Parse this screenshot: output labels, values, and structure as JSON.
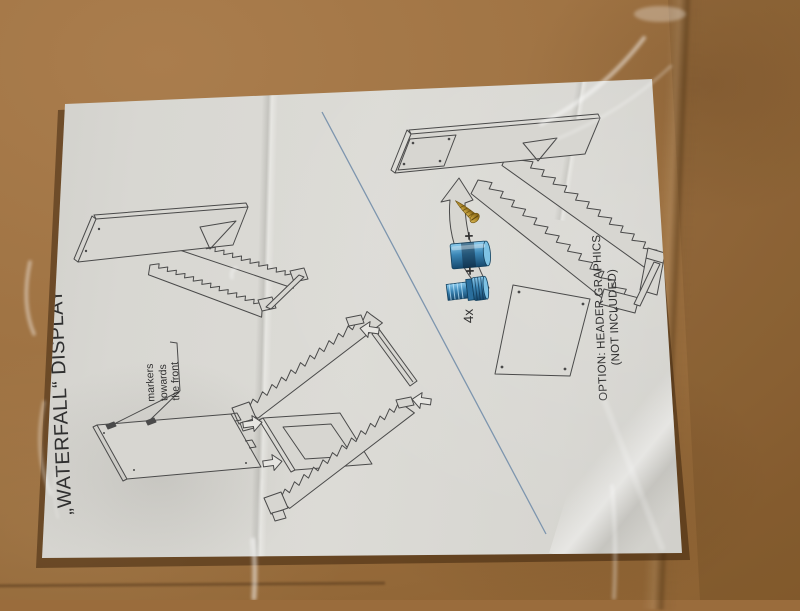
{
  "photo": {
    "sheet": {
      "title": "„WATERFALL“ DISPLAY",
      "markers_note": [
        "markers",
        "towards",
        "the front"
      ],
      "quantity_label": "4x",
      "plus_sign": "+",
      "option_note": [
        "OPTION: HEADER GRAPHICS",
        "(NOT INCLUDED)"
      ]
    },
    "colors": {
      "cardboard": "#9a6c3c",
      "paper": "#d7d6d1",
      "line_art": "#4a4a4a",
      "divider_blue": "#7d95ae",
      "fastener_blue": "#3b86b5",
      "screw_brass": "#a5812e"
    }
  }
}
